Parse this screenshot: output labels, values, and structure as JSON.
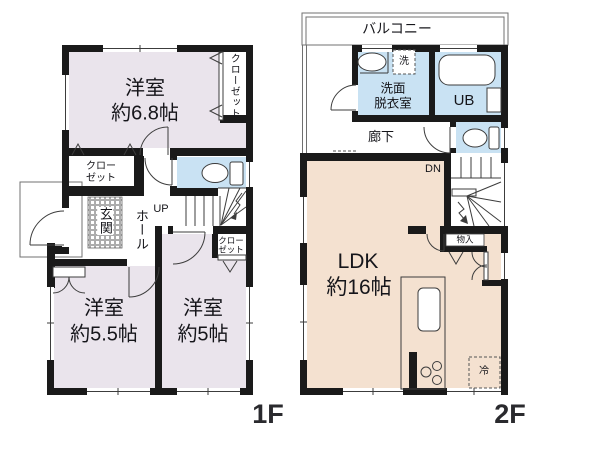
{
  "colors": {
    "wall_color": "#1a1a1a",
    "room_pink": "#eae4ec",
    "wet_blue": "#c9e2f3",
    "ldk_peach": "#f4e1d0"
  },
  "floor1": {
    "label": "1F",
    "room_68": {
      "name": "洋室",
      "size": "約6.8帖"
    },
    "room_55": {
      "name": "洋室",
      "size": "約5.5帖"
    },
    "room_50": {
      "name": "洋室",
      "size": "約5帖"
    },
    "closet_vertical": "クローゼット",
    "closet_l1": "クロー",
    "closet_l2": "ゼット",
    "stairs_closet_l1": "クロー",
    "stairs_closet_l2": "ゼット",
    "entrance": "玄関",
    "hall": "ホール",
    "stairs_up": "UP"
  },
  "floor2": {
    "label": "2F",
    "balcony": "バルコニー",
    "washroom_l1": "洗面",
    "washroom_l2": "脱衣室",
    "laundry": "洗",
    "unit_bath": "UB",
    "corridor": "廊下",
    "stairs_down": "DN",
    "storage": "物入",
    "ldk": {
      "name": "LDK",
      "size": "約16帖"
    },
    "fridge": "冷"
  }
}
